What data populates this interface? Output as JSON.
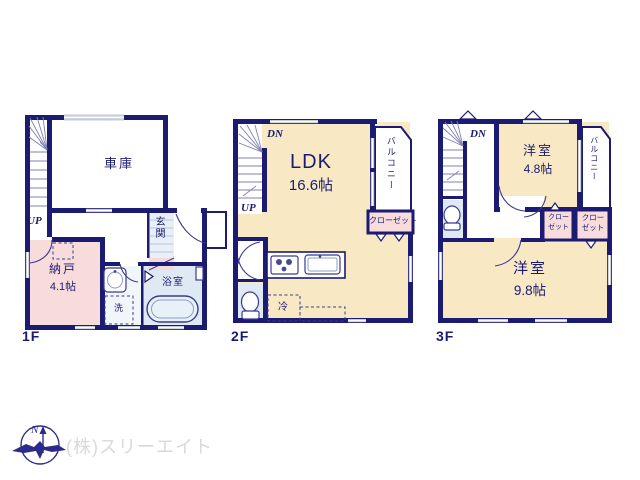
{
  "colors": {
    "wall": "#1b1b72",
    "text": "#1b1b72",
    "cream": "#f8e9c4",
    "pink": "#f8dcdc",
    "blue": "#dfe9f3",
    "window": "#c6cbd9",
    "gray": "#d9d9d9",
    "compass": "#2b2b8c"
  },
  "f1": {
    "label": "1F",
    "garage": "車庫",
    "up": "UP",
    "entrance": "玄関",
    "storage_name": "納戸",
    "storage_size": "4.1帖",
    "washer": "洗",
    "bath": "浴室"
  },
  "f2": {
    "label": "2F",
    "dn": "DN",
    "up": "UP",
    "ldk_name": "LDK",
    "ldk_size": "16.6帖",
    "balcony": "バルコニー",
    "closet": "クローゼット",
    "fridge": "冷"
  },
  "f3": {
    "label": "3F",
    "dn": "DN",
    "room_small_name": "洋室",
    "room_small_size": "4.8帖",
    "room_large_name": "洋室",
    "room_large_size": "9.8帖",
    "balcony": "バルコニー",
    "closet_left_line1": "クロー",
    "closet_left_line2": "ゼット",
    "closet_right_line1": "クロー",
    "closet_right_line2": "ゼット"
  },
  "footer": {
    "north": "N",
    "company": "(株)スリーエイト"
  }
}
